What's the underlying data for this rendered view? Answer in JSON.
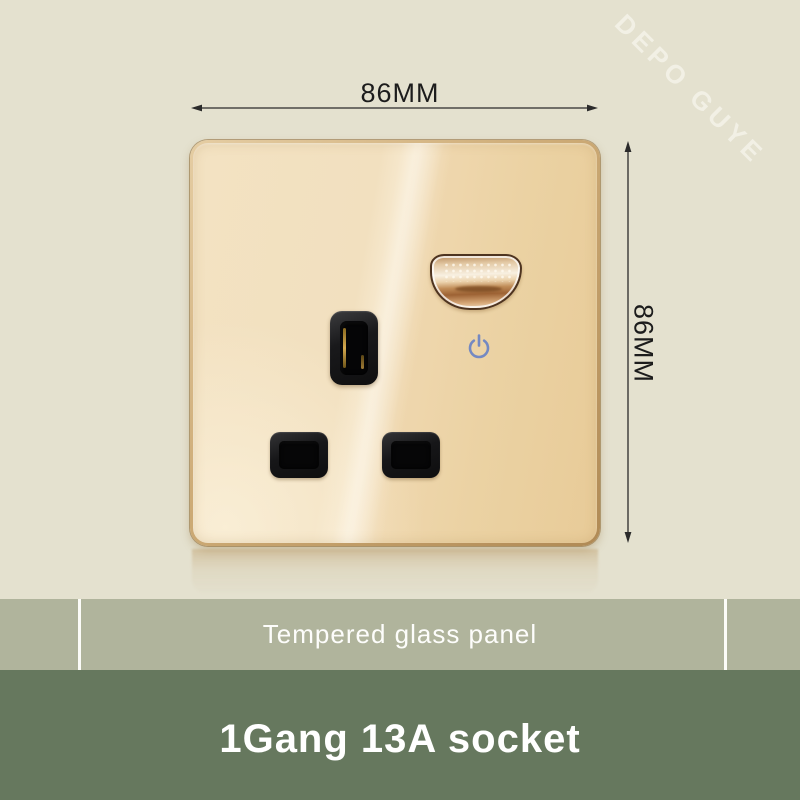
{
  "watermark": {
    "text": "DEPO GUYE"
  },
  "annotations": {
    "width_label": "86MM",
    "height_label": "86MM"
  },
  "product": {
    "banner_label": "Tempered glass panel",
    "title": "1Gang 13A socket"
  },
  "icons": {
    "power": "power-icon"
  },
  "colors": {
    "background": "#e4e1cf",
    "glass_gold": "#eed6ab",
    "frame_gold": "#c6a571",
    "banner_bg": "#b0b49c",
    "footer_bg": "#66785e",
    "power_icon_blue": "#7489c2",
    "dimension_line": "#2b2b2b",
    "slot_black": "#161618"
  }
}
